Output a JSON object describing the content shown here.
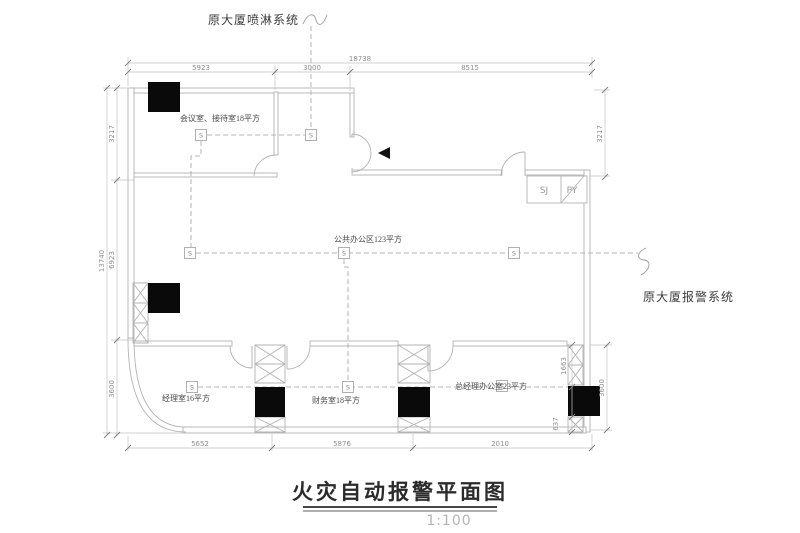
{
  "drawing": {
    "title": "火灾自动报警平面图",
    "scale": "1:100",
    "annotation_top": "原大厦喷淋系统",
    "annotation_right": "原大厦报警系统",
    "rooms": {
      "meeting": "会议室、接待室18平方",
      "open_office": "公共办公区123平方",
      "manager": "经理室16平方",
      "finance": "财务室18平方",
      "gm_office": "总经理办公室23平方"
    },
    "shafts": {
      "sj": "SJ",
      "py": "PY"
    },
    "detector_glyph": "S",
    "dims": {
      "top_total": "18738",
      "top_1": "5923",
      "top_2": "3000",
      "top_3": "8515",
      "left_total": "13740",
      "left_1": "3217",
      "left_2": "6923",
      "left_3": "3600",
      "right_1": "3217",
      "right_2": "3600",
      "inner_1": "1663",
      "inner_2": "637",
      "bottom_1": "5652",
      "bottom_2": "5876",
      "bottom_3": "2010"
    },
    "colors": {
      "wall": "#b3b3b3",
      "dim_line": "#b8b8b8",
      "tick": "#7d7d7d",
      "dashed": "#a3a3a3",
      "device": "#0a0a0a",
      "text": "#4a4a4a"
    }
  }
}
